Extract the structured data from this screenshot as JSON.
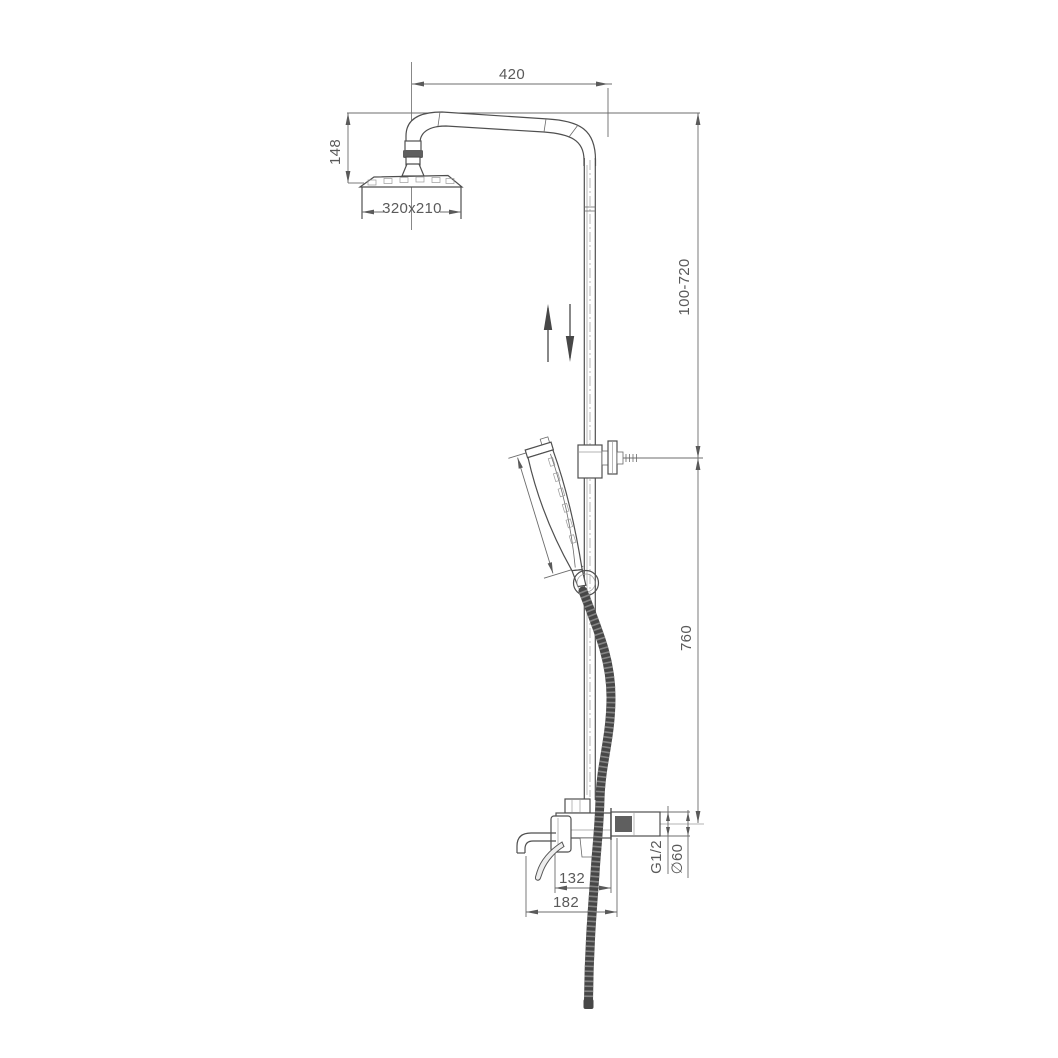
{
  "title": "Shower column technical drawing",
  "drawing": {
    "labels": {
      "arm_width": "420",
      "head_drop": "148",
      "head_size": "320x210",
      "riser_range": "100-720",
      "handshower_length": "254",
      "riser_lower": "760",
      "spout_reach_inner": "132",
      "spout_reach_outer": "182",
      "thread_size": "G1/2",
      "flange_diameter": "∅60"
    },
    "colors": {
      "line": "#4f4f4f",
      "dimension": "#5a5a5a",
      "hose": "#474747",
      "background": "#ffffff"
    }
  }
}
